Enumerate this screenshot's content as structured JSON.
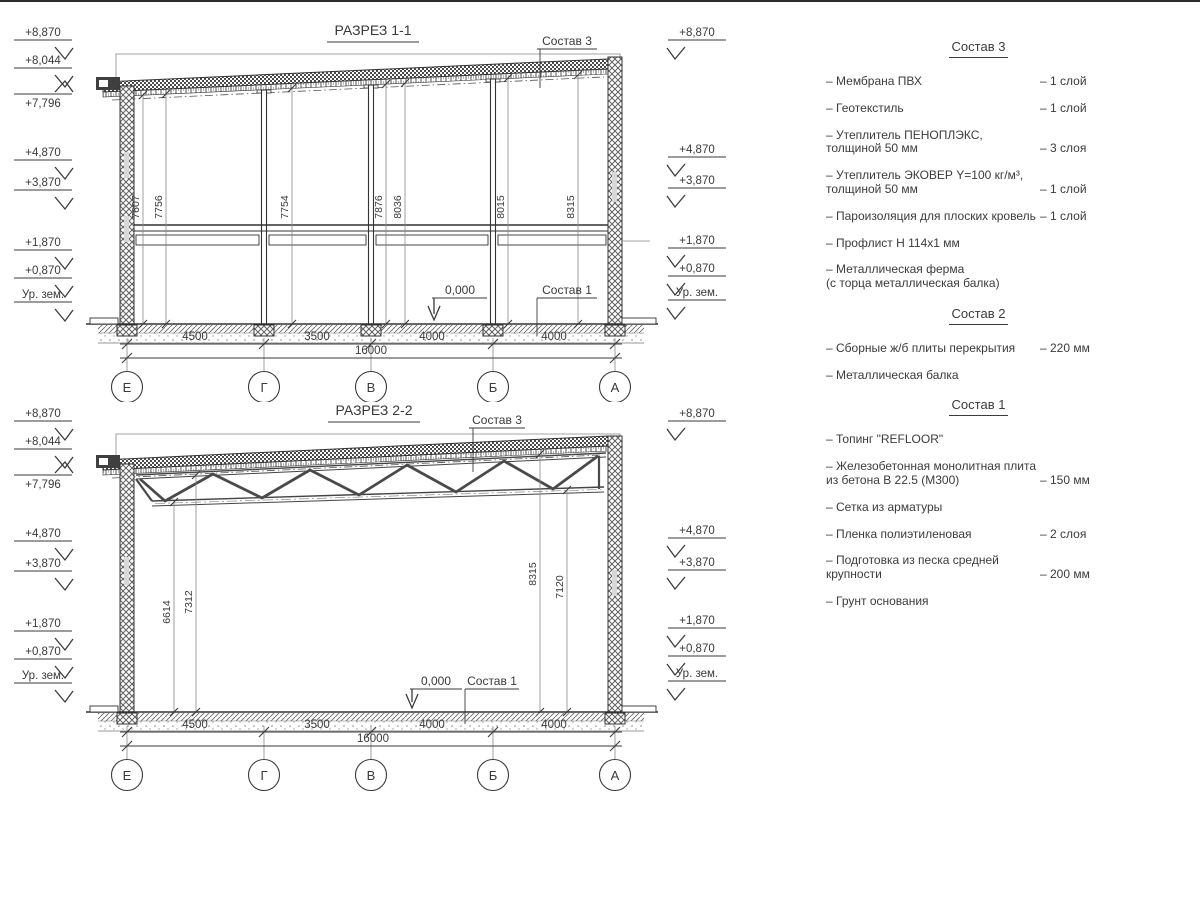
{
  "colors": {
    "ink": "#3a3a3a"
  },
  "sections": {
    "s1": {
      "title": "РАЗРЕЗ 1-1",
      "elev_left": [
        "+8,870",
        "+8,044",
        "+7,796",
        "+4,870",
        "+3,870",
        "+1,870",
        "+0,870",
        "Ур. зем."
      ],
      "elev_right": [
        "+8,870",
        "+4,870",
        "+3,870",
        "+1,870",
        "+0,870",
        "Ур. зем."
      ],
      "dims_vertical": [
        "7607",
        "7756",
        "7754",
        "7876",
        "8036",
        "8015",
        "8315"
      ],
      "dims_bottom": [
        "4500",
        "3500",
        "4000",
        "4000"
      ],
      "dim_total": "16000",
      "axes": [
        "Е",
        "Г",
        "В",
        "Б",
        "А"
      ],
      "labels": {
        "sostav3": "Состав 3",
        "sostav1": "Состав 1",
        "zero": "0,000"
      }
    },
    "s2": {
      "title": "РАЗРЕЗ 2-2",
      "elev_left": [
        "+8,870",
        "+8,044",
        "+7,796",
        "+4,870",
        "+3,870",
        "+1,870",
        "+0,870",
        "Ур. зем."
      ],
      "elev_right": [
        "+8,870",
        "+4,870",
        "+3,870",
        "+1,870",
        "+0,870",
        "Ур. зем."
      ],
      "dims_vertical": [
        "6614",
        "7312",
        "8315",
        "7120"
      ],
      "dims_bottom": [
        "4500",
        "3500",
        "4000",
        "4000"
      ],
      "dim_total": "16000",
      "axes": [
        "Е",
        "Г",
        "В",
        "Б",
        "А"
      ],
      "labels": {
        "sostav3": "Состав 3",
        "sostav1": "Состав 1",
        "zero": "0,000"
      }
    }
  },
  "legend": {
    "sostav3": {
      "title": "Состав 3",
      "items": [
        {
          "name": "– Мембрана ПВХ",
          "qty": "– 1 слой"
        },
        {
          "name": "– Геотекстиль",
          "qty": "– 1 слой"
        },
        {
          "name": "– Утеплитель ПЕНОПЛЭКС,\nтолщиной 50 мм",
          "qty": "– 3 слоя"
        },
        {
          "name": "– Утеплитель ЭКОВЕР Y=100 кг/м³,\nтолщиной 50 мм",
          "qty": "– 1 слой"
        },
        {
          "name": "– Пароизоляция для плоских кровель",
          "qty": "– 1 слой"
        },
        {
          "name": "– Профлист Н 114х1 мм",
          "qty": ""
        },
        {
          "name": "– Металлическая ферма\n(с торца металлическая балка)",
          "qty": ""
        }
      ]
    },
    "sostav2": {
      "title": "Состав 2",
      "items": [
        {
          "name": "– Сборные ж/б плиты перекрытия",
          "qty": "– 220 мм"
        },
        {
          "name": "– Металлическая балка",
          "qty": ""
        }
      ]
    },
    "sostav1": {
      "title": "Состав 1",
      "items": [
        {
          "name": "– Топинг \"REFLOOR\"",
          "qty": ""
        },
        {
          "name": "– Железобетонная  монолитная плита\nиз бетона В 22.5 (М300)",
          "qty": "– 150 мм"
        },
        {
          "name": "– Сетка из арматуры",
          "qty": ""
        },
        {
          "name": "– Пленка полиэтиленовая",
          "qty": "– 2 слоя"
        },
        {
          "name": "– Подготовка из песка средней\nкрупности",
          "qty": "– 200 мм"
        },
        {
          "name": "– Грунт основания",
          "qty": ""
        }
      ]
    }
  }
}
